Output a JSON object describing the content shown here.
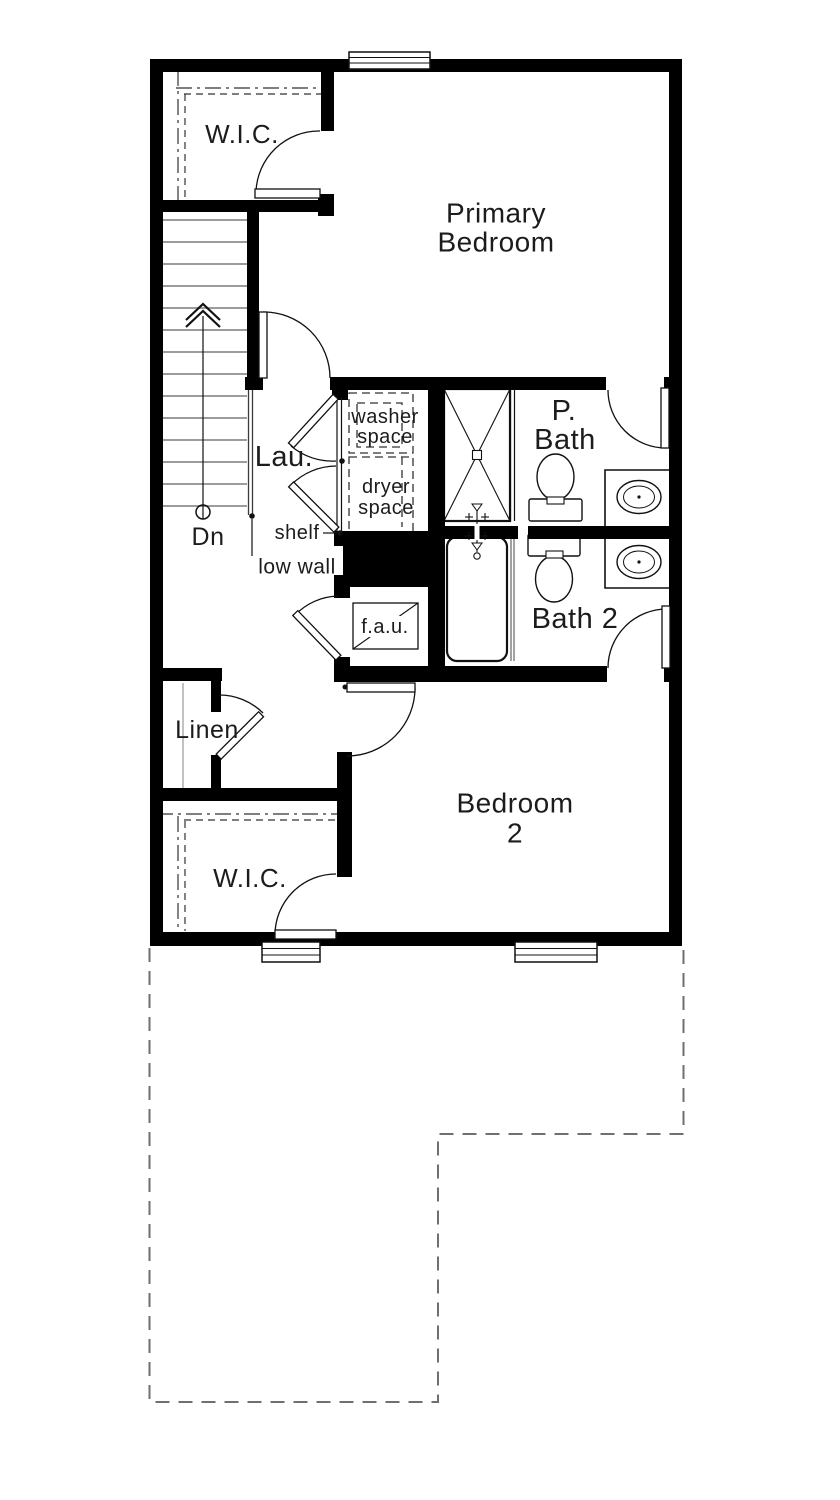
{
  "plan": {
    "rooms": {
      "wic_primary": {
        "label": "W.I.C."
      },
      "primary_bedroom": {
        "line1": "Primary",
        "line2": "Bedroom"
      },
      "laundry": {
        "label": "Lau."
      },
      "p_bath": {
        "line1": "P.",
        "line2": "Bath"
      },
      "bath2": {
        "label": "Bath 2"
      },
      "linen": {
        "label": "Linen"
      },
      "bedroom2": {
        "line1": "Bedroom",
        "line2": "2"
      },
      "wic_bedroom2": {
        "label": "W.I.C."
      }
    },
    "fixtures": {
      "washer": {
        "line1": "washer",
        "line2": "space"
      },
      "dryer": {
        "line1": "dryer",
        "line2": "space"
      },
      "fau": {
        "label": "f.a.u."
      }
    },
    "annotations": {
      "shelf": "shelf",
      "low_wall": "low wall",
      "stairs_down": "Dn"
    },
    "colors": {
      "wall": "#000000",
      "text": "#1c1c1c",
      "tread": "#9c9c9c",
      "footprint_dash": "#6f6f6f"
    }
  }
}
